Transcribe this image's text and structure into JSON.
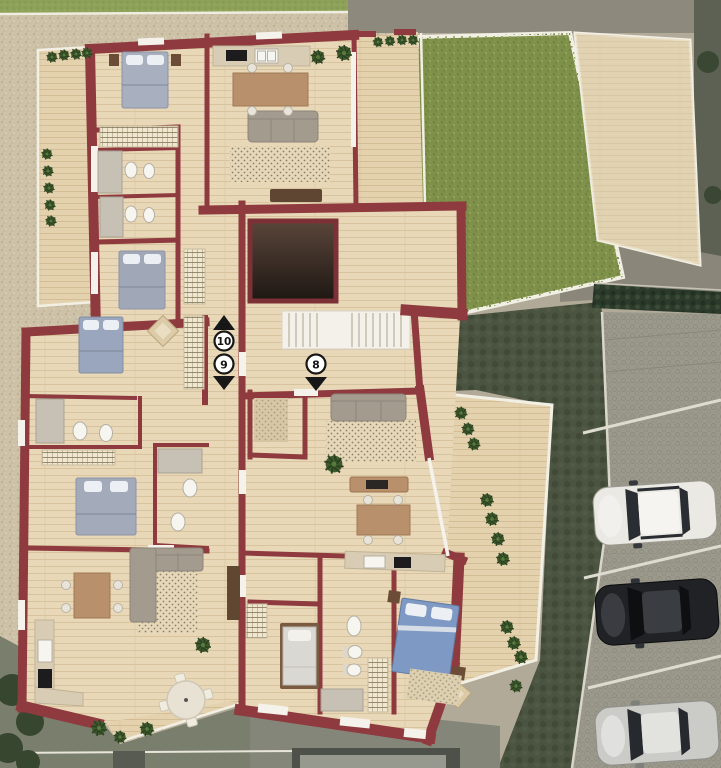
{
  "scene": {
    "description": "3D rendered architectural floor plan, top-down view, with garden and parking",
    "visible_labels": [
      "10",
      "9",
      "8"
    ]
  },
  "markers": [
    {
      "label": "10",
      "arrow": "up"
    },
    {
      "label": "9",
      "arrow": "down"
    },
    {
      "label": "8",
      "arrow": "down"
    }
  ],
  "palette": {
    "wall": "#8e3a3e",
    "floor_wood": "#e8d8b8",
    "terrace_wood": "#e4d2ae",
    "gravel": "#cdc2a8",
    "grass_strip": "#8da158",
    "garden": "#7e9049",
    "patio": "#ded2b6",
    "pavement": "#9b988c",
    "dark_ground": "#4b5440",
    "hedge": "#2c3a2b",
    "stairs": "#f3f1ea",
    "elevator_dark": "#241a15",
    "sofa": "#a29b8e",
    "bed_gray": "#a8b0bf",
    "bed_blue": "#7d99c4",
    "furniture_wood": "#b8906c",
    "fixture_white": "#f7f5f0"
  },
  "building": {
    "core": {
      "features": [
        "staircase",
        "elevator"
      ]
    },
    "units": [
      {
        "marker": "10",
        "access": "stairs-up"
      },
      {
        "marker": "9",
        "access": "stairs-down",
        "rooms": [
          "bedroom",
          "bathroom",
          "bedroom",
          "bathroom",
          "living-dining",
          "kitchen",
          "terrace"
        ]
      },
      {
        "marker": "8",
        "access": "stairs-down",
        "rooms": [
          "living-dining",
          "kitchen",
          "bedroom",
          "bathroom",
          "master-bedroom",
          "terrace"
        ]
      }
    ]
  },
  "outdoor": {
    "garden_lawn": true,
    "patios": 2,
    "hedges": true,
    "gravel_yard": true
  },
  "parking": {
    "stalls": 4,
    "occupied": 3,
    "cars": [
      {
        "name": "white-suv",
        "color": "#ebe9e4",
        "glass": "#2a2d31"
      },
      {
        "name": "black-sedan",
        "color": "#202226",
        "glass": "#0e0f11"
      },
      {
        "name": "silver-sedan",
        "color": "#cbccc8",
        "glass": "#26292d"
      }
    ]
  }
}
